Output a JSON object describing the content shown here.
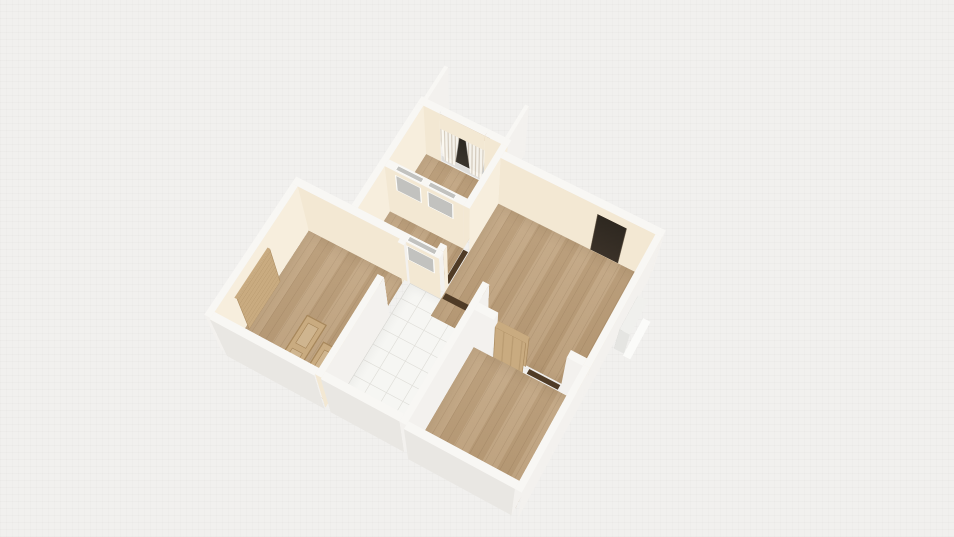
{
  "scene": {
    "type": "3d-floor-plan-render",
    "rooms": [
      {
        "id": "balcony",
        "floor": "concrete"
      },
      {
        "id": "window-room",
        "floor": "wood"
      },
      {
        "id": "hallway",
        "floor": "wood"
      },
      {
        "id": "bedroom",
        "floor": "wood"
      },
      {
        "id": "bathroom",
        "floor": "tile"
      },
      {
        "id": "living-room",
        "floor": "wood"
      },
      {
        "id": "bottom-room",
        "floor": "wood"
      }
    ],
    "objects": [
      "curtained-window",
      "curtain-rod",
      "window-glass",
      "window-sill",
      "interior-glass-window",
      "interior-glass-window",
      "interior-glass-window",
      "dark-entry-door",
      "radiator",
      "door-panel-standing",
      "door-panel-standing",
      "door-panel-flat",
      "door-panel-flat",
      "doorway-threshold",
      "doorway-threshold",
      "doorway-threshold"
    ]
  },
  "colors": {
    "background": "#f1f0ee",
    "wall_top": "#f8f7f4",
    "wall_interior": "#f3e8d3",
    "wall_interior_light": "#f7eedd",
    "wall_exterior": "#f3f1ee",
    "wall_exterior_shade": "#e9e7e3",
    "floor_wood": "#bfa17b",
    "floor_tile": "#f6f6f3",
    "tile_line": "#e0dfda",
    "balcony_concrete": "#9ea2a6",
    "balcony_concrete_light": "#c9cbcc",
    "balcony_wood": "#b29877",
    "door_dark": "#2e2820",
    "door_wood": "#c9ab80",
    "door_wood_dark": "#a8885c",
    "curtain": "#fbf8f1",
    "curtain_shade": "#d8cfc0",
    "window_glass": "#2b2721",
    "pelmet": "#b48c66",
    "rod": "#6b6257",
    "sill": "#dfdedb",
    "radiator_dark": "#96968f",
    "radiator_light": "#d2d2cf",
    "threshold": "#4f3b26",
    "glass_pane": "#c2c2bf"
  }
}
